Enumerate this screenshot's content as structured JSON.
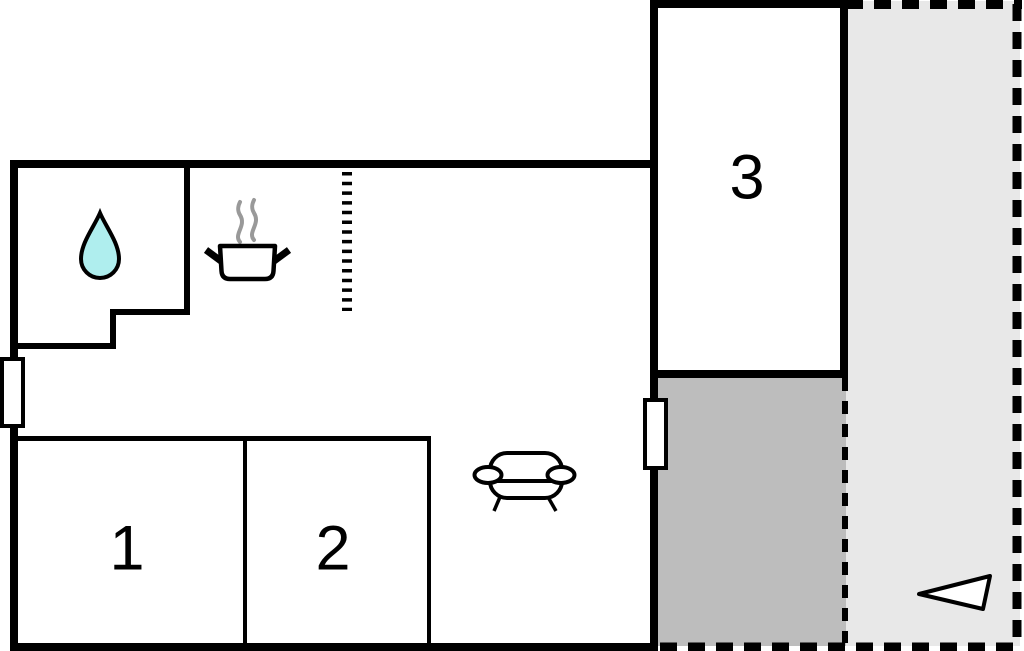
{
  "canvas": {
    "width": 1024,
    "height": 651,
    "background": "#ffffff"
  },
  "rooms": [
    {
      "label": "1"
    },
    {
      "label": "2"
    },
    {
      "label": "3"
    }
  ],
  "areas": [
    {
      "name": "covered-terrace-area",
      "fill": "#bdbdbd"
    },
    {
      "name": "open-terrace-area",
      "fill": "#e8e8e8"
    }
  ],
  "icons": {
    "water_drop": "water-drop-icon",
    "cooking_pot": "cooking-pot-icon",
    "steam": "steam-icon",
    "sofa": "sofa-icon",
    "direction_arrow": "direction-arrow-icon",
    "window": "window-icon",
    "dashed_partition": "dashed-partition-icon"
  },
  "colors": {
    "wall": "#000000",
    "water_drop_fill": "#afeeee",
    "steam_stroke": "#999999",
    "terrace_dark": "#bdbdbd",
    "terrace_light": "#e8e8e8",
    "icon_fill": "#ffffff",
    "background": "#ffffff"
  }
}
